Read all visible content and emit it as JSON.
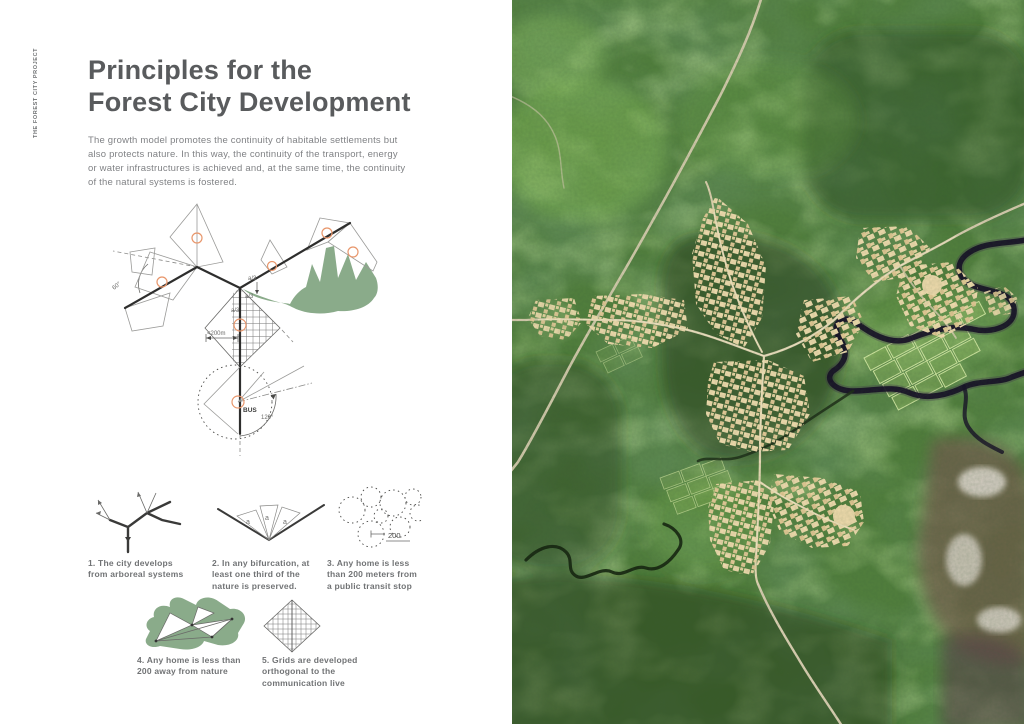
{
  "page": {
    "project_label": "THE FOREST CITY PROJECT",
    "title": "Principles for the\nForest City Development",
    "intro": "The growth model promotes the continuity of habitable settlements but\nalso protects nature. In this way, the continuity of the transport, energy\nor water infrastructures is achieved and, at the same time, the continuity\nof the natural systems is fostered."
  },
  "diagram": {
    "labels": {
      "angle_60": "60°",
      "a_third_1": "a/3",
      "a_third_2": "a/3",
      "a_third_3": "a/3",
      "max_distance": "<200m",
      "bus": "BUS",
      "angle_120": "120°"
    },
    "colors": {
      "nature_green": "#8aab8a",
      "node_orange": "#e8966b",
      "line_dark": "#2e2e2d"
    }
  },
  "principles": [
    {
      "caption": "1. The city develops\nfrom arboreal systems"
    },
    {
      "caption": "2. In any bifurcation, at\nleast one third of the\nnature is preserved.",
      "triangle_labels": [
        "a",
        "a",
        "a"
      ]
    },
    {
      "caption": "3. Any home is less\nthan 200 meters from\na public transit stop",
      "radius_label": "200"
    },
    {
      "caption": "4. Any home is less than\n200 away from nature"
    },
    {
      "caption": "5. Grids are developed\northogonal to the\ncommunication live"
    }
  ],
  "satellite": {
    "description": "aerial photo of forest with branching tri-armed settlement clusters, roads, farm fields and dark meandering river",
    "colors": {
      "forest_base": "#517e3d",
      "forest_dark": "#243f1e",
      "forest_light": "#7fb355",
      "settlement_tan": "#ead7a9",
      "road_tan": "#d6cbae",
      "river_dark": "#171027",
      "cleared_brown": "#6e5a49",
      "sand_white": "#ddd8ce"
    }
  }
}
